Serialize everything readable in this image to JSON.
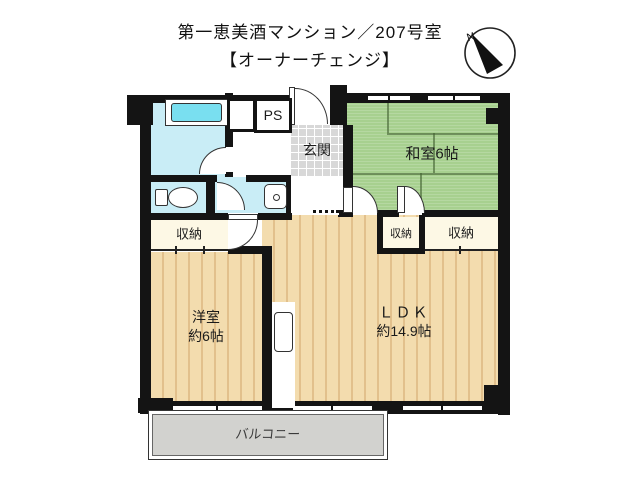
{
  "title": {
    "line1": "第一恵美酒マンション／207号室",
    "line2": "【オーナーチェンジ】"
  },
  "compass": {
    "north_label": "N"
  },
  "rooms": {
    "washitsu": {
      "label": "和室6帖"
    },
    "youshitsu": {
      "line1": "洋室",
      "line2": "約6帖"
    },
    "ldk": {
      "line1": "ＬＤＫ",
      "line2": "約14.9帖"
    },
    "genkan": {
      "label": "玄関"
    },
    "pipe_space": {
      "label": "PS"
    },
    "balcony": {
      "label": "バルコニー"
    },
    "closets": [
      {
        "label": "収納"
      },
      {
        "label": "収納"
      },
      {
        "label": "収納"
      }
    ]
  },
  "colors": {
    "wall": "#141414",
    "wet_room": "#c9edf6",
    "bath_water": "#79dff0",
    "tatami_green": "#a7d08f",
    "wood_floor": "#f3dcae",
    "closet_cream": "#fdf8e5",
    "entry_tile": "#d8d8d8",
    "balcony_gray": "#d2d2cf"
  }
}
